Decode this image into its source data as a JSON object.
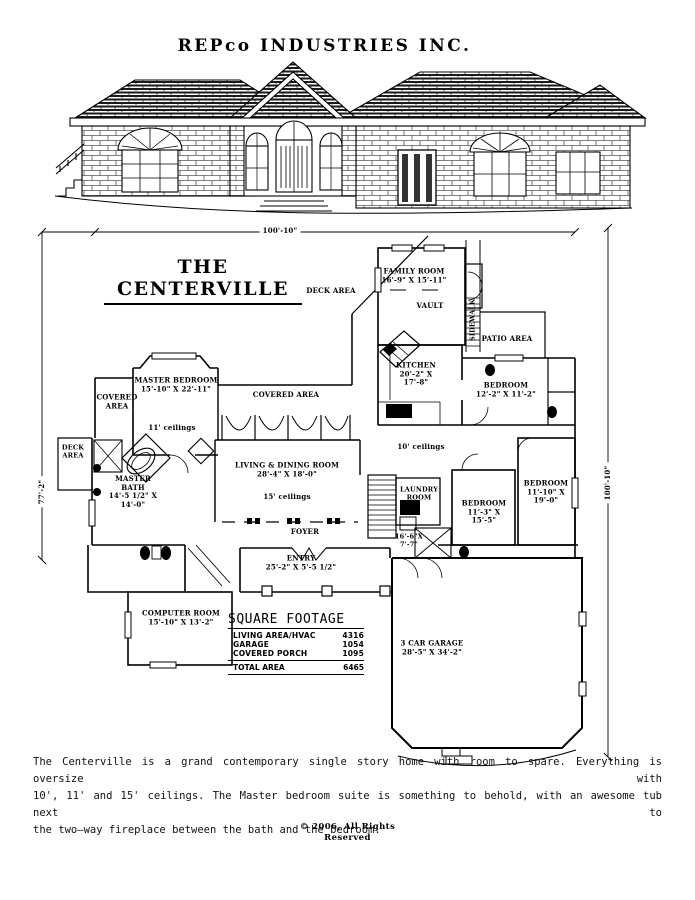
{
  "header": {
    "company": "REPco  INDUSTRIES  INC."
  },
  "plan": {
    "title": "THE  CENTERVILLE",
    "dim_top": "100'-10\"",
    "dim_left": "77'-2\"",
    "dim_right": "100'-10\"",
    "labels": {
      "deck_area_upper": "DECK  AREA",
      "family_room": {
        "name": "FAMILY ROOM",
        "dims": "16'-9\" X 15'-11\""
      },
      "vault": "VAULT",
      "sidewalk": "SIDEWALK",
      "patio_area": "PATIO  AREA",
      "kitchen": {
        "name": "KITCHEN",
        "dims_line1": "20'-2\" X",
        "dims_line2": "17'-8\""
      },
      "bedroom_ne": {
        "name": "BEDROOM",
        "dims": "12'-2\" X 11'-2\""
      },
      "covered_area_left": {
        "line1": "COVERED",
        "line2": "AREA"
      },
      "master_bedroom": {
        "name": "MASTER BEDROOM",
        "dims": "15'-10\" X 22'-11\""
      },
      "covered_area_right": "COVERED  AREA",
      "ceilings_11": "11' ceilings",
      "deck_area_left": {
        "line1": "DECK",
        "line2": "AREA"
      },
      "master_bath": {
        "name_line1": "MASTER",
        "name_line2": "BATH",
        "dims_line1": "14'-5 1/2\" X",
        "dims_line2": "14'-0\""
      },
      "ceilings_10": "10' ceilings",
      "living_dining": {
        "name": "LIVING & DINING ROOM",
        "dims": "28'-4\" X 18'-0\""
      },
      "ceilings_15": "15' ceilings",
      "laundry": {
        "name_line1": "LAUNDRY",
        "name_line2": "ROOM",
        "dims_line1": "16'-6\"X",
        "dims_line2": "7'-7\""
      },
      "bedroom_mid": {
        "name": "BEDROOM",
        "dims_line1": "11'-3\" X",
        "dims_line2": "15'-5\""
      },
      "bedroom_east": {
        "name": "BEDROOM",
        "dims_line1": "11'-10\" X",
        "dims_line2": "19'-0\""
      },
      "foyer": "FOYER",
      "entry": {
        "name": "ENTRY",
        "dims": "25'-2\" X 5'-5 1/2\""
      },
      "computer_room": {
        "name": "COMPUTER ROOM",
        "dims": "15'-10\" X 13'-2\""
      },
      "garage": {
        "name": "3 CAR GARAGE",
        "dims": "28'-5\" X 34'-2\""
      }
    },
    "square_footage": {
      "title": "SQUARE  FOOTAGE",
      "rows": [
        {
          "label": "LIVING AREA/HVAC",
          "value": "4316"
        },
        {
          "label": "GARAGE",
          "value": "1054"
        },
        {
          "label": "COVERED PORCH",
          "value": "1095"
        }
      ],
      "total": {
        "label": "TOTAL  AREA",
        "value": "6465"
      }
    }
  },
  "description_lines": [
    "The Centerville is a grand contemporary single story home with room to spare. Everything is oversize with",
    "10', 11' and 15' ceilings. The Master bedroom suite is something to behold, with an awesome tub next to",
    "the two—way fireplace between the bath and the bedroom."
  ],
  "footer": {
    "copyright_line1": "© 2006, All Rights",
    "copyright_line2": "Reserved"
  }
}
